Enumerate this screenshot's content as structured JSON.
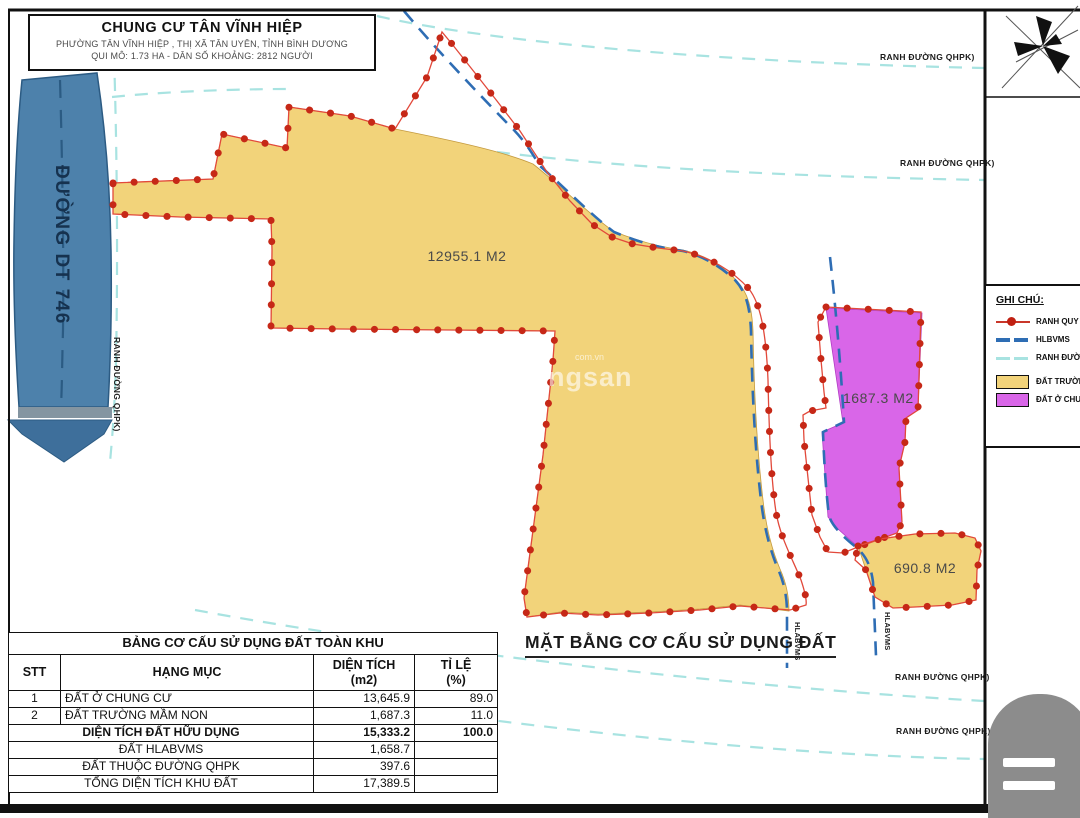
{
  "title_block": {
    "line1": "CHUNG CƯ TÂN VĨNH HIỆP",
    "line2": "PHƯỜNG TÂN VĨNH HIỆP , THỊ XÃ TÂN UYÊN, TỈNH BÌNH DƯƠNG",
    "line3": "QUI MÔ: 1.73 HA - DÂN SỐ KHOẢNG: 2812 NGƯỜI"
  },
  "road": {
    "name": "ĐƯỜNG DT 746",
    "edge_label": "RANH ĐƯỜNG QHPK)"
  },
  "map": {
    "plan_title": "MẶT BẰNG CƠ CẤU SỬ DỤNG ĐẤT",
    "areas": [
      {
        "label": "12955.1 M2"
      },
      {
        "label": "1687.3 M2"
      },
      {
        "label": "690.8 M2"
      }
    ],
    "qhpk_labels": [
      {
        "text": "RANH ĐƯỜNG QHPK)"
      },
      {
        "text": "RANH ĐƯỜNG QHPK)"
      },
      {
        "text": "RANH ĐƯỜNG QHPK)"
      },
      {
        "text": "RANH ĐƯỜNG QHPK)"
      }
    ],
    "hlabvms_labels": [
      {
        "text": "HLABVMS"
      },
      {
        "text": "HLABVMS"
      }
    ]
  },
  "legend": {
    "heading": "GHI CHÚ:",
    "items": [
      {
        "type": "boundary-red",
        "label": "RANH QUY HO"
      },
      {
        "type": "hlbvms-dash",
        "label": "HLBVMS"
      },
      {
        "type": "qhpk-dash",
        "label": "RANH ĐƯỜNG"
      },
      {
        "type": "fill-yellow",
        "label": "ĐẤT TRƯỜNG"
      },
      {
        "type": "fill-purple",
        "label": "ĐẤT Ở CHUNG"
      }
    ]
  },
  "table": {
    "title": "BẢNG CƠ CẤU SỬ DỤNG ĐẤT TOÀN KHU",
    "headers": {
      "stt": "STT",
      "category": "HẠNG MỤC",
      "area1": "DIỆN  TÍCH",
      "area2": "(m2)",
      "ratio1": "TỈ LỆ",
      "ratio2": "(%)"
    },
    "rows": [
      {
        "stt": "1",
        "category": "ĐẤT Ở CHUNG CƯ",
        "area": "13,645.9",
        "ratio": "89.0"
      },
      {
        "stt": "2",
        "category": "ĐẤT TRƯỜNG MẦM NON",
        "area": "1,687.3",
        "ratio": "11.0"
      }
    ],
    "summary": [
      {
        "label": "DIỆN TÍCH ĐẤT HỮU DỤNG",
        "area": "15,333.2",
        "ratio": "100.0"
      },
      {
        "label": "ĐẤT HLABVMS",
        "area": "1,658.7",
        "ratio": ""
      },
      {
        "label": "ĐẤT THUỘC ĐƯỜNG QHPK",
        "area": "397.6",
        "ratio": ""
      },
      {
        "label": "TỔNG DIỆN TÍCH KHU ĐẤT",
        "area": "17,389.5",
        "ratio": ""
      }
    ]
  },
  "watermark": {
    "big": "ngsan",
    "small": "com.vn"
  },
  "colors": {
    "parcel_yellow": "#F2D37A",
    "parcel_purple": "#D966E8",
    "road_blue": "#4D81AB",
    "arrow_blue": "#3E6F9B",
    "boundary_red_dot": "#C62817",
    "boundary_red_line": "#E2493B",
    "hlbvms_blue": "#2E6DB4",
    "qhpk_cyan": "#A8E3E1",
    "frame_black": "#111111",
    "handle_gray": "#8C8C8C"
  }
}
